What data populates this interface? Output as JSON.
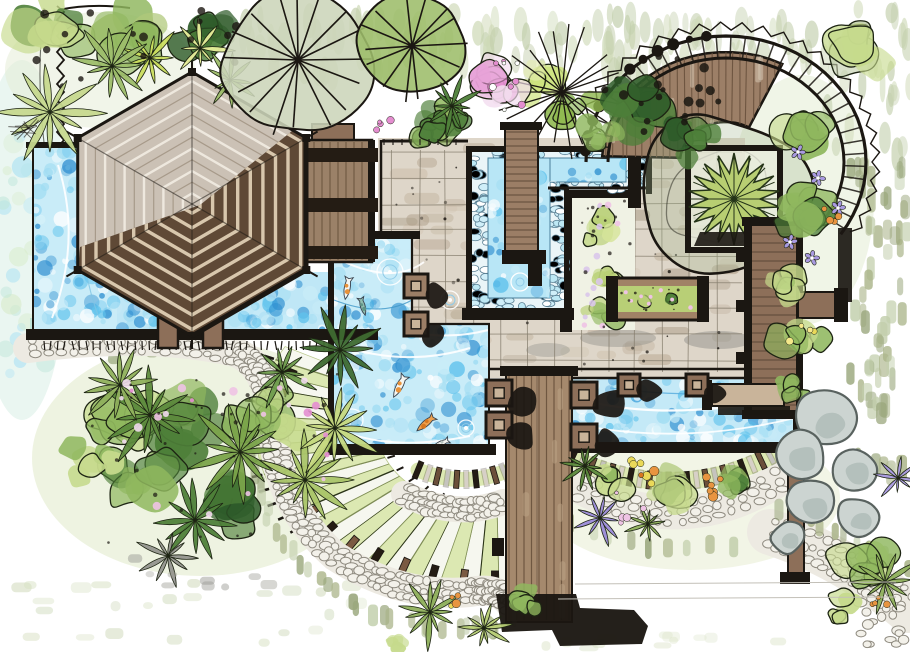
{
  "meta": {
    "title": "Hand-drawn landscape architecture plan: tropical garden with hexagonal pavilion, koi pond, plunge pool, lap pool, timber boardwalk, radial lawn terraces, cobble paths, curved pergola and planting beds"
  },
  "palette": {
    "paper": "#ffffff",
    "ink": "#1b1712",
    "water_light": "#c9ecf8",
    "water_mid": "#5fc2ec",
    "water_deep": "#2f8fd0",
    "water_pale": "#a8e0f4",
    "water_edge": "#b8e2d8",
    "wood": "#8d6f59",
    "wood_dark": "#5c4737",
    "wood_light": "#c9b49a",
    "plank_line": "#6a523d",
    "walkway": "#a5896d",
    "roof_light": "#cbc1b5",
    "roof_ring": "#eee8de",
    "roof_ring_mid": "#a79a8a",
    "roof_dark": "#5f4936",
    "roof_ring_dark": "#d8c7ad",
    "tile": "#ded6c9",
    "tile_dab": "#b9a893",
    "tile_grid": "#857d6d",
    "cobble": "#edeae2",
    "cobble_stone": "#f3f1ea",
    "cobble_line": "#8f8b80",
    "stripe_green": "#dce8b2",
    "stripe_pale": "#f6f7ef",
    "leaf_light": "#c6da8c",
    "leaf_mid": "#8fb75e",
    "leaf_dark": "#4e7f39",
    "leaf_deep": "#2f5c2a",
    "sage": "#c3cfad",
    "olive": "#9aa77d",
    "flower_pink": "#eec3e4",
    "flower_magenta": "#e48ed0",
    "flower_orange": "#e89440",
    "flower_purple": "#a99ae0",
    "flower_yellow": "#ead95a",
    "rock": "#ccd4d1",
    "rock_line": "#59625f",
    "rock_shade": "#a3b2ae",
    "shadow_gray": "#8a8a85",
    "wash_green": "#e0e9c8",
    "wash_blue": "#d9eee6",
    "pergola_band": "#cfc8bd",
    "pergola_wood": "#9c7f67",
    "tree_wash": "rgba(163,181,142,0.3)",
    "koi_white": "#f4f6f2",
    "koi_orange": "#e8923a",
    "koi_teal": "#8fbcae"
  },
  "features": {
    "pavilion": "hexagonal pavilion roof",
    "left_pool": "reflecting pool",
    "koi_pond": "koi pond with fish and ripples",
    "plunge_pool": "pebble-edged plunge pool with timber bridge",
    "lap_pool": "lap pool with wave pattern",
    "boardwalk": "timber boardwalk",
    "fan_terrace": "radial lawn steps",
    "stone_path": "cobblestone garden path",
    "pergola": "curved pergola with canopy tree planter",
    "planting": "tropical planting beds with palms and flowers",
    "rocks": "boulder cluster",
    "terrace": "stone tile terrace with furniture"
  }
}
